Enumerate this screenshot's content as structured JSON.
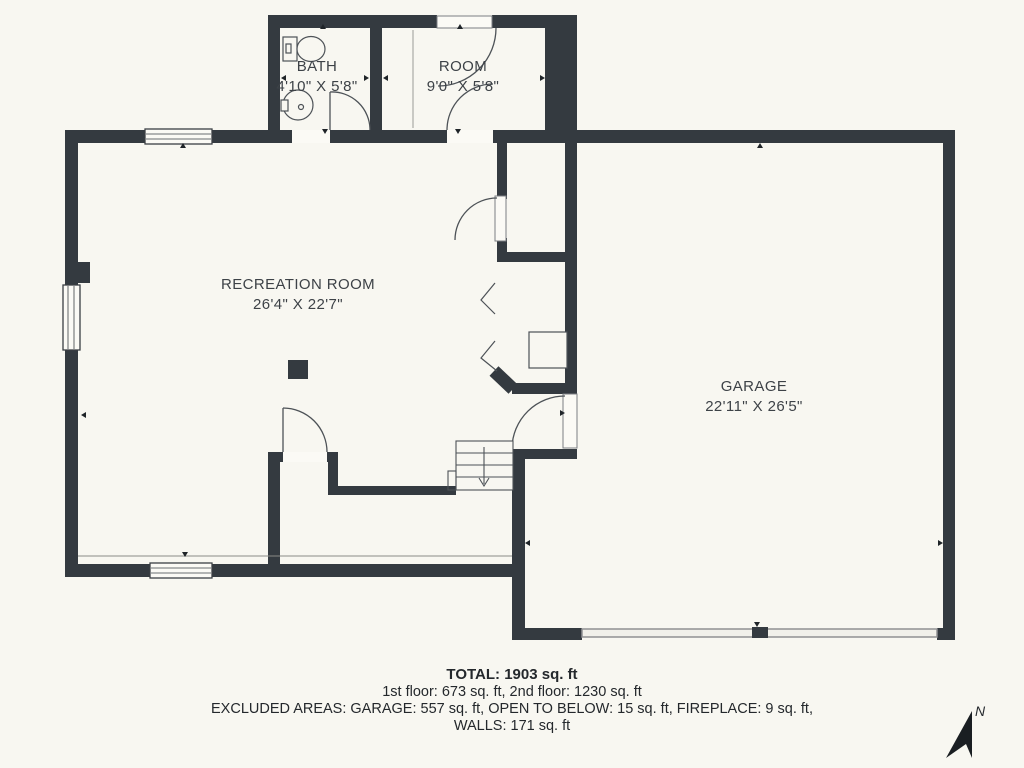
{
  "plan": {
    "rooms": [
      {
        "id": "bath",
        "name": "BATH",
        "dimensions": "4'10\" X 5'8\""
      },
      {
        "id": "room",
        "name": "ROOM",
        "dimensions": "9'0\" X 5'8\""
      },
      {
        "id": "recreation-room",
        "name": "RECREATION ROOM",
        "dimensions": "26'4\" X 22'7\""
      },
      {
        "id": "garage",
        "name": "GARAGE",
        "dimensions": "22'11\" X 26'5\""
      }
    ],
    "summary": {
      "total": "TOTAL: 1903 sq. ft",
      "floors": "1st floor: 673 sq. ft, 2nd floor: 1230 sq. ft",
      "excluded": "EXCLUDED AREAS: GARAGE: 557 sq. ft, OPEN TO BELOW: 15 sq. ft, FIREPLACE: 9 sq. ft,",
      "walls": "WALLS: 171 sq. ft"
    },
    "compass": {
      "label": "N"
    },
    "colors": {
      "wall": "#343a40",
      "background": "#f8f7f1",
      "line": "#4d5257",
      "marker": "#1f2428"
    },
    "icons": [
      "toilet-icon",
      "sink-icon",
      "stairs-icon",
      "door-swing-icon",
      "window-icon",
      "north-arrow-icon",
      "fireplace-icon",
      "column-icon",
      "garage-door-icon"
    ]
  }
}
